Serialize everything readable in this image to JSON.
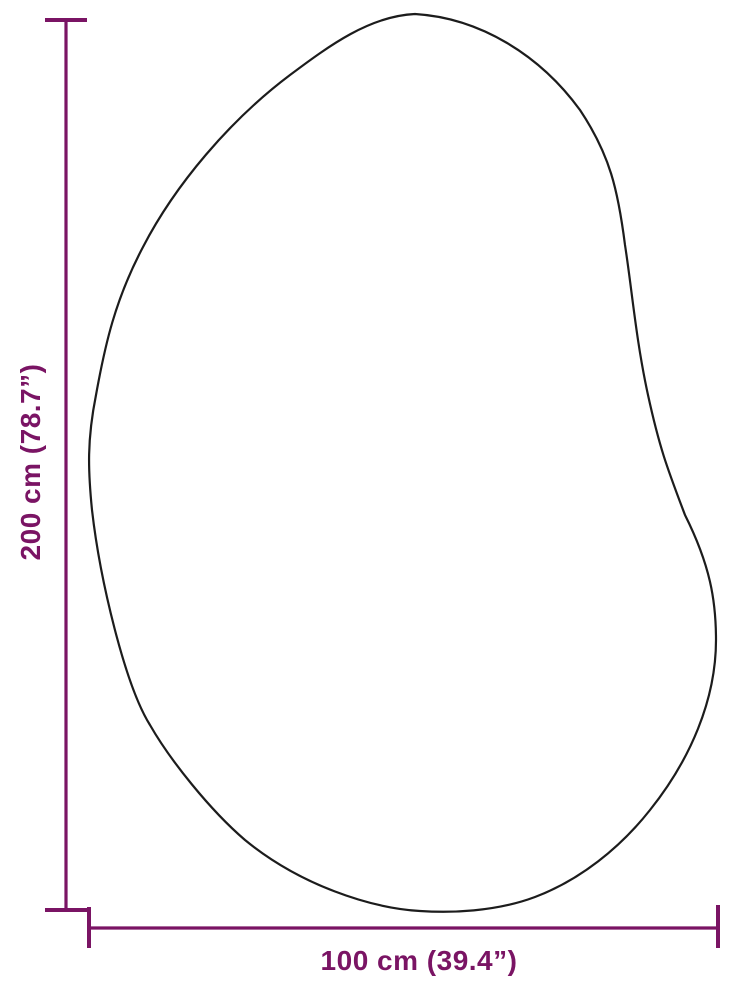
{
  "diagram": {
    "height_label": "200 cm (78.7”)",
    "width_label": "100 cm (39.4”)",
    "height_cm": "200",
    "height_inches": "78.7",
    "width_cm": "100",
    "width_inches": "39.4",
    "unit": "cm",
    "accent_color": "#7a1464",
    "outline_color": "#1c1c1c",
    "background_color": "#ffffff"
  }
}
